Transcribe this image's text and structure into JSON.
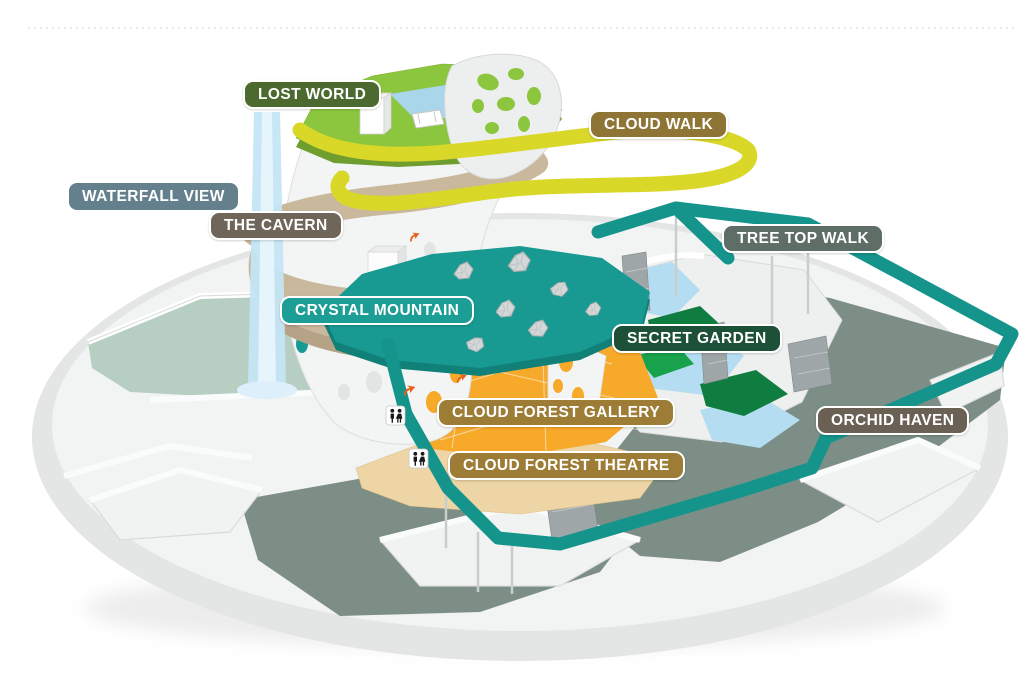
{
  "map": {
    "name": "cloud-forest-attraction-map",
    "labels": [
      {
        "id": "lost-world",
        "text": "LOST WORLD",
        "bg": "#4c6a2f",
        "border": "#ffffff",
        "x": 243,
        "y": 80
      },
      {
        "id": "cloud-walk",
        "text": "CLOUD WALK",
        "bg": "#8e7435",
        "border": "#ffffff",
        "x": 589,
        "y": 110
      },
      {
        "id": "waterfall-view",
        "text": "WATERFALL VIEW",
        "bg": "#64808d",
        "border": "",
        "x": 69,
        "y": 183
      },
      {
        "id": "the-cavern",
        "text": "THE CAVERN",
        "bg": "#6f6659",
        "border": "#ffffff",
        "x": 209,
        "y": 211
      },
      {
        "id": "tree-top-walk",
        "text": "TREE TOP WALK",
        "bg": "#5e6d65",
        "border": "#ffffff",
        "x": 722,
        "y": 224
      },
      {
        "id": "crystal-mountain",
        "text": "CRYSTAL MOUNTAIN",
        "bg": "#1c9d95",
        "border": "#ffffff",
        "x": 280,
        "y": 296
      },
      {
        "id": "secret-garden",
        "text": "SECRET GARDEN",
        "bg": "#1c5138",
        "border": "#ffffff",
        "x": 612,
        "y": 324
      },
      {
        "id": "cloud-forest-gallery",
        "text": "CLOUD FOREST GALLERY",
        "bg": "#9d7d36",
        "border": "#ffffff",
        "x": 437,
        "y": 398
      },
      {
        "id": "orchid-haven",
        "text": "ORCHID HAVEN",
        "bg": "#6a6054",
        "border": "#ffffff",
        "x": 816,
        "y": 406
      },
      {
        "id": "cloud-forest-theatre",
        "text": "CLOUD FOREST THEATRE",
        "bg": "#9d7d36",
        "border": "#ffffff",
        "x": 448,
        "y": 451
      }
    ],
    "icons": [
      {
        "name": "restroom-icon",
        "x": 387,
        "y": 407
      },
      {
        "name": "restroom-icon",
        "x": 410,
        "y": 450
      },
      {
        "name": "direction-arrow-icon",
        "x": 402,
        "y": 390
      },
      {
        "name": "direction-arrow-icon",
        "x": 455,
        "y": 378
      },
      {
        "name": "direction-arrow-icon",
        "x": 408,
        "y": 237
      }
    ],
    "colors": {
      "lost_world_green": "#8cc63f",
      "plateau_under_green": "#6f9e2e",
      "cloud_walk_yellow": "#d9d728",
      "tree_top_walk_teal": "#15948c",
      "crystal_platform_teal": "#189a92",
      "crystal_platform_rim": "#108078",
      "gallery_orange": "#f7a929",
      "theatre_beige": "#edd5a5",
      "cavern_tan": "#c9b89c",
      "cavern_tan_dark": "#b5a287",
      "stream_blue": "#b5ddf1",
      "waterfall_blue": "#c4e5f5",
      "garden_dark_green": "#0e7d3f",
      "garden_bright_green": "#17a24b",
      "floor_dark_sage": "#7c8e85",
      "floor_light_sage": "#b7cfc2",
      "pond_blue": "#a9d6ea",
      "arrow_orange": "#e8611c",
      "base_gray": "#e4e5e5"
    }
  }
}
